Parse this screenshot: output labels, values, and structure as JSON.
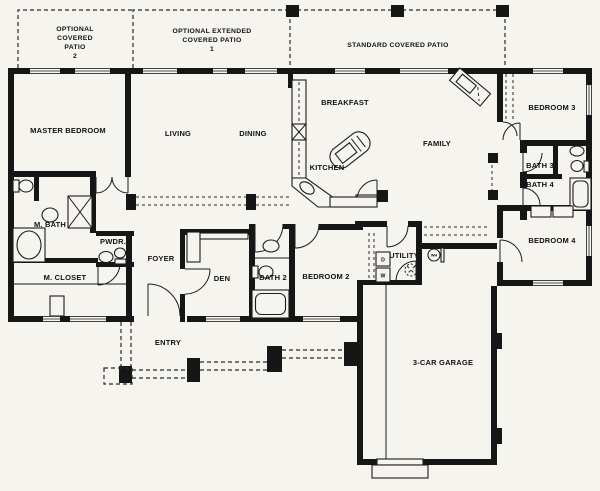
{
  "plan": {
    "patios": {
      "optional_covered_patio_2": [
        "OPTIONAL",
        "COVERED",
        "PATIO",
        "2"
      ],
      "optional_extended_covered_patio_1": [
        "OPTIONAL EXTENDED",
        "COVERED PATIO",
        "1"
      ],
      "standard_covered_patio": "STANDARD COVERED PATIO"
    },
    "rooms": {
      "master_bedroom": "MASTER BEDROOM",
      "living": "LIVING",
      "dining": "DINING",
      "breakfast": "BREAKFAST",
      "kitchen": "KITCHEN",
      "family": "FAMILY",
      "bedroom_3": "BEDROOM 3",
      "bath_3": "BATH 3",
      "bath_4": "BATH 4",
      "bedroom_4": "BEDROOM 4",
      "m_bath": "M. BATH",
      "pwdr": "PWDR.",
      "m_closet": "M. CLOSET",
      "foyer": "FOYER",
      "den": "DEN",
      "bath_2": "BATH 2",
      "bedroom_2": "BEDROOM 2",
      "utility": "UTILITY",
      "entry": "ENTRY",
      "garage": "3-CAR GARAGE"
    },
    "appliances": {
      "dryer": "D",
      "washer": "W",
      "water_heater": "WH"
    },
    "colors": {
      "background": "#f5f4ef",
      "line": "#161616"
    }
  }
}
